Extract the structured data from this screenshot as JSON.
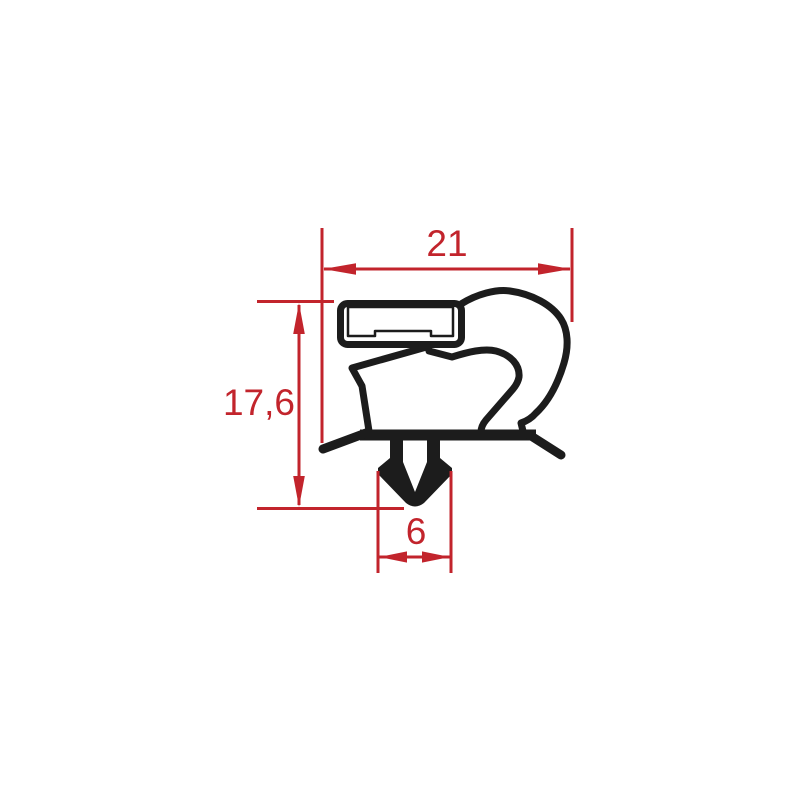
{
  "drawing": {
    "type": "gasket-profile-cross-section",
    "dimensions": {
      "overall_width": {
        "label": "21"
      },
      "overall_height": {
        "label": "17,6"
      },
      "dart_width": {
        "label": "6"
      }
    },
    "parts": [
      "magnet-insert-block",
      "hatched-core",
      "balloon-bulb",
      "bellows",
      "base-bar",
      "left-lip",
      "right-lip",
      "push-in-dart"
    ]
  },
  "colors": {
    "dimension_red": "#c2242c",
    "profile_black": "#1c1c1c",
    "background": "#ffffff"
  }
}
